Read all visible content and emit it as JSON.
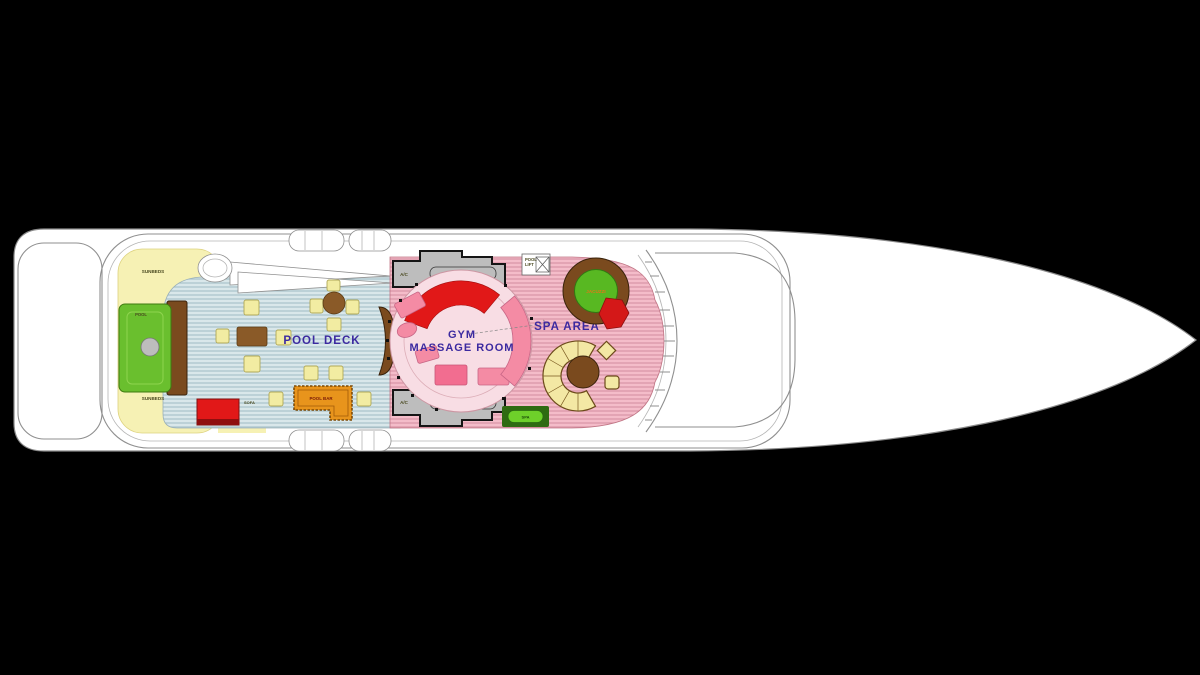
{
  "diagram": {
    "type": "yacht-deck-floor-plan",
    "labels": {
      "pool_deck": "POOL DECK",
      "gym": "GYM",
      "massage_room": "MASSAGE ROOM",
      "spa_area": "SPA AREA",
      "sunbeds": "SUNBEDS",
      "pool": "POOL",
      "sofa": "SOFA",
      "pool_bar": "POOL BAR",
      "jacuzzi": "JACUZZI",
      "pool_lift_line1": "POOL",
      "pool_lift_line2": "LIFT",
      "ac": "A/C",
      "spa_pill": "SPA"
    },
    "colors": {
      "background": "#000000",
      "hull_white": "#ffffff",
      "deck_teal": "#d9e7ea",
      "deck_teal_stripe": "#a9c3cb",
      "deck_pink": "#f4bcc9",
      "deck_pink_stripe": "#d893a5",
      "sunpad_yellow": "#f6f1b4",
      "pool_green": "#6abf2e",
      "jacuzzi_green": "#58b822",
      "accent_red": "#e11818",
      "bar_orange": "#e8941c",
      "wood_brown": "#7a4a1e",
      "gym_circle": "#f8dde4",
      "label_purple": "#4a2aa0",
      "label_blue": "#2a2a9e"
    }
  }
}
